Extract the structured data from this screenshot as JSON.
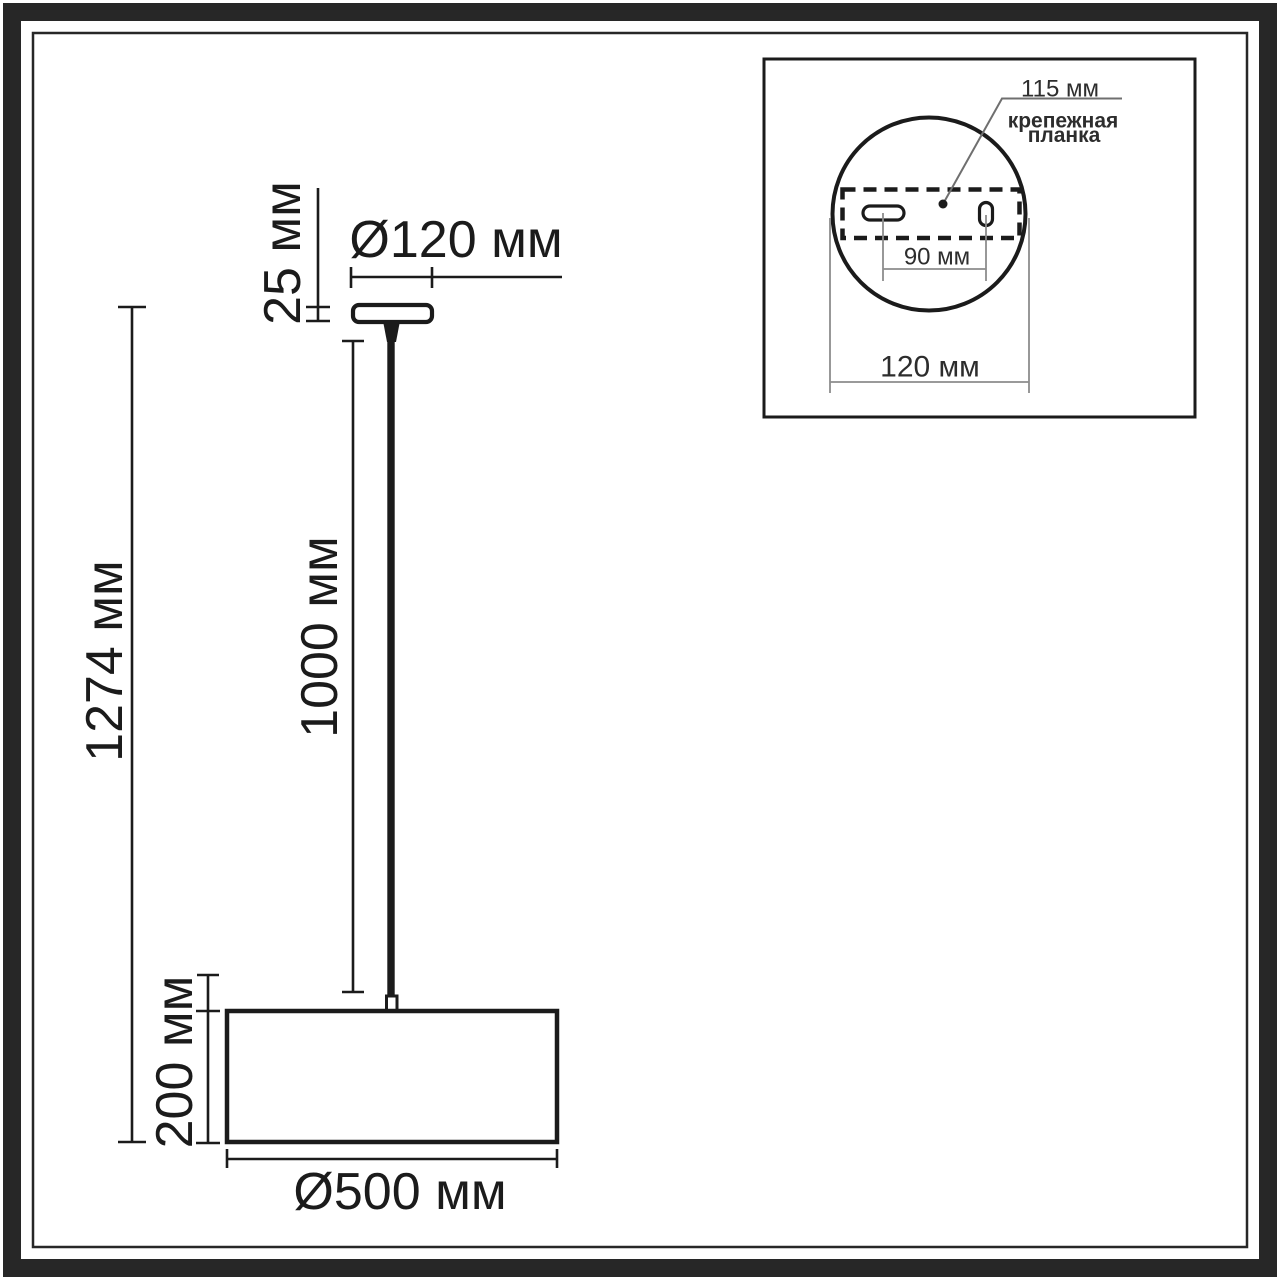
{
  "document": {
    "type": "pendant-lamp-dimension-drawing",
    "background": "#ffffff"
  },
  "colors": {
    "frame": "#272727",
    "line": "#1b1b1b",
    "dim_gray": "#8c8c8c",
    "leader_gray": "#6f6f6f"
  },
  "main_diagram": {
    "labels": {
      "canopy_thickness": "25 мм",
      "canopy_diameter": "Ø120 мм",
      "overall_height": "1274 мм",
      "rod_length": "1000 мм",
      "shade_height": "200 мм",
      "shade_diameter": "Ø500 мм"
    }
  },
  "inset_detail": {
    "labels": {
      "bracket_length": "115 мм",
      "bracket_caption_line1": "крепежная",
      "bracket_caption_line2": "планка",
      "hole_spacing": "90 мм",
      "plate_diameter": "120 мм"
    }
  }
}
